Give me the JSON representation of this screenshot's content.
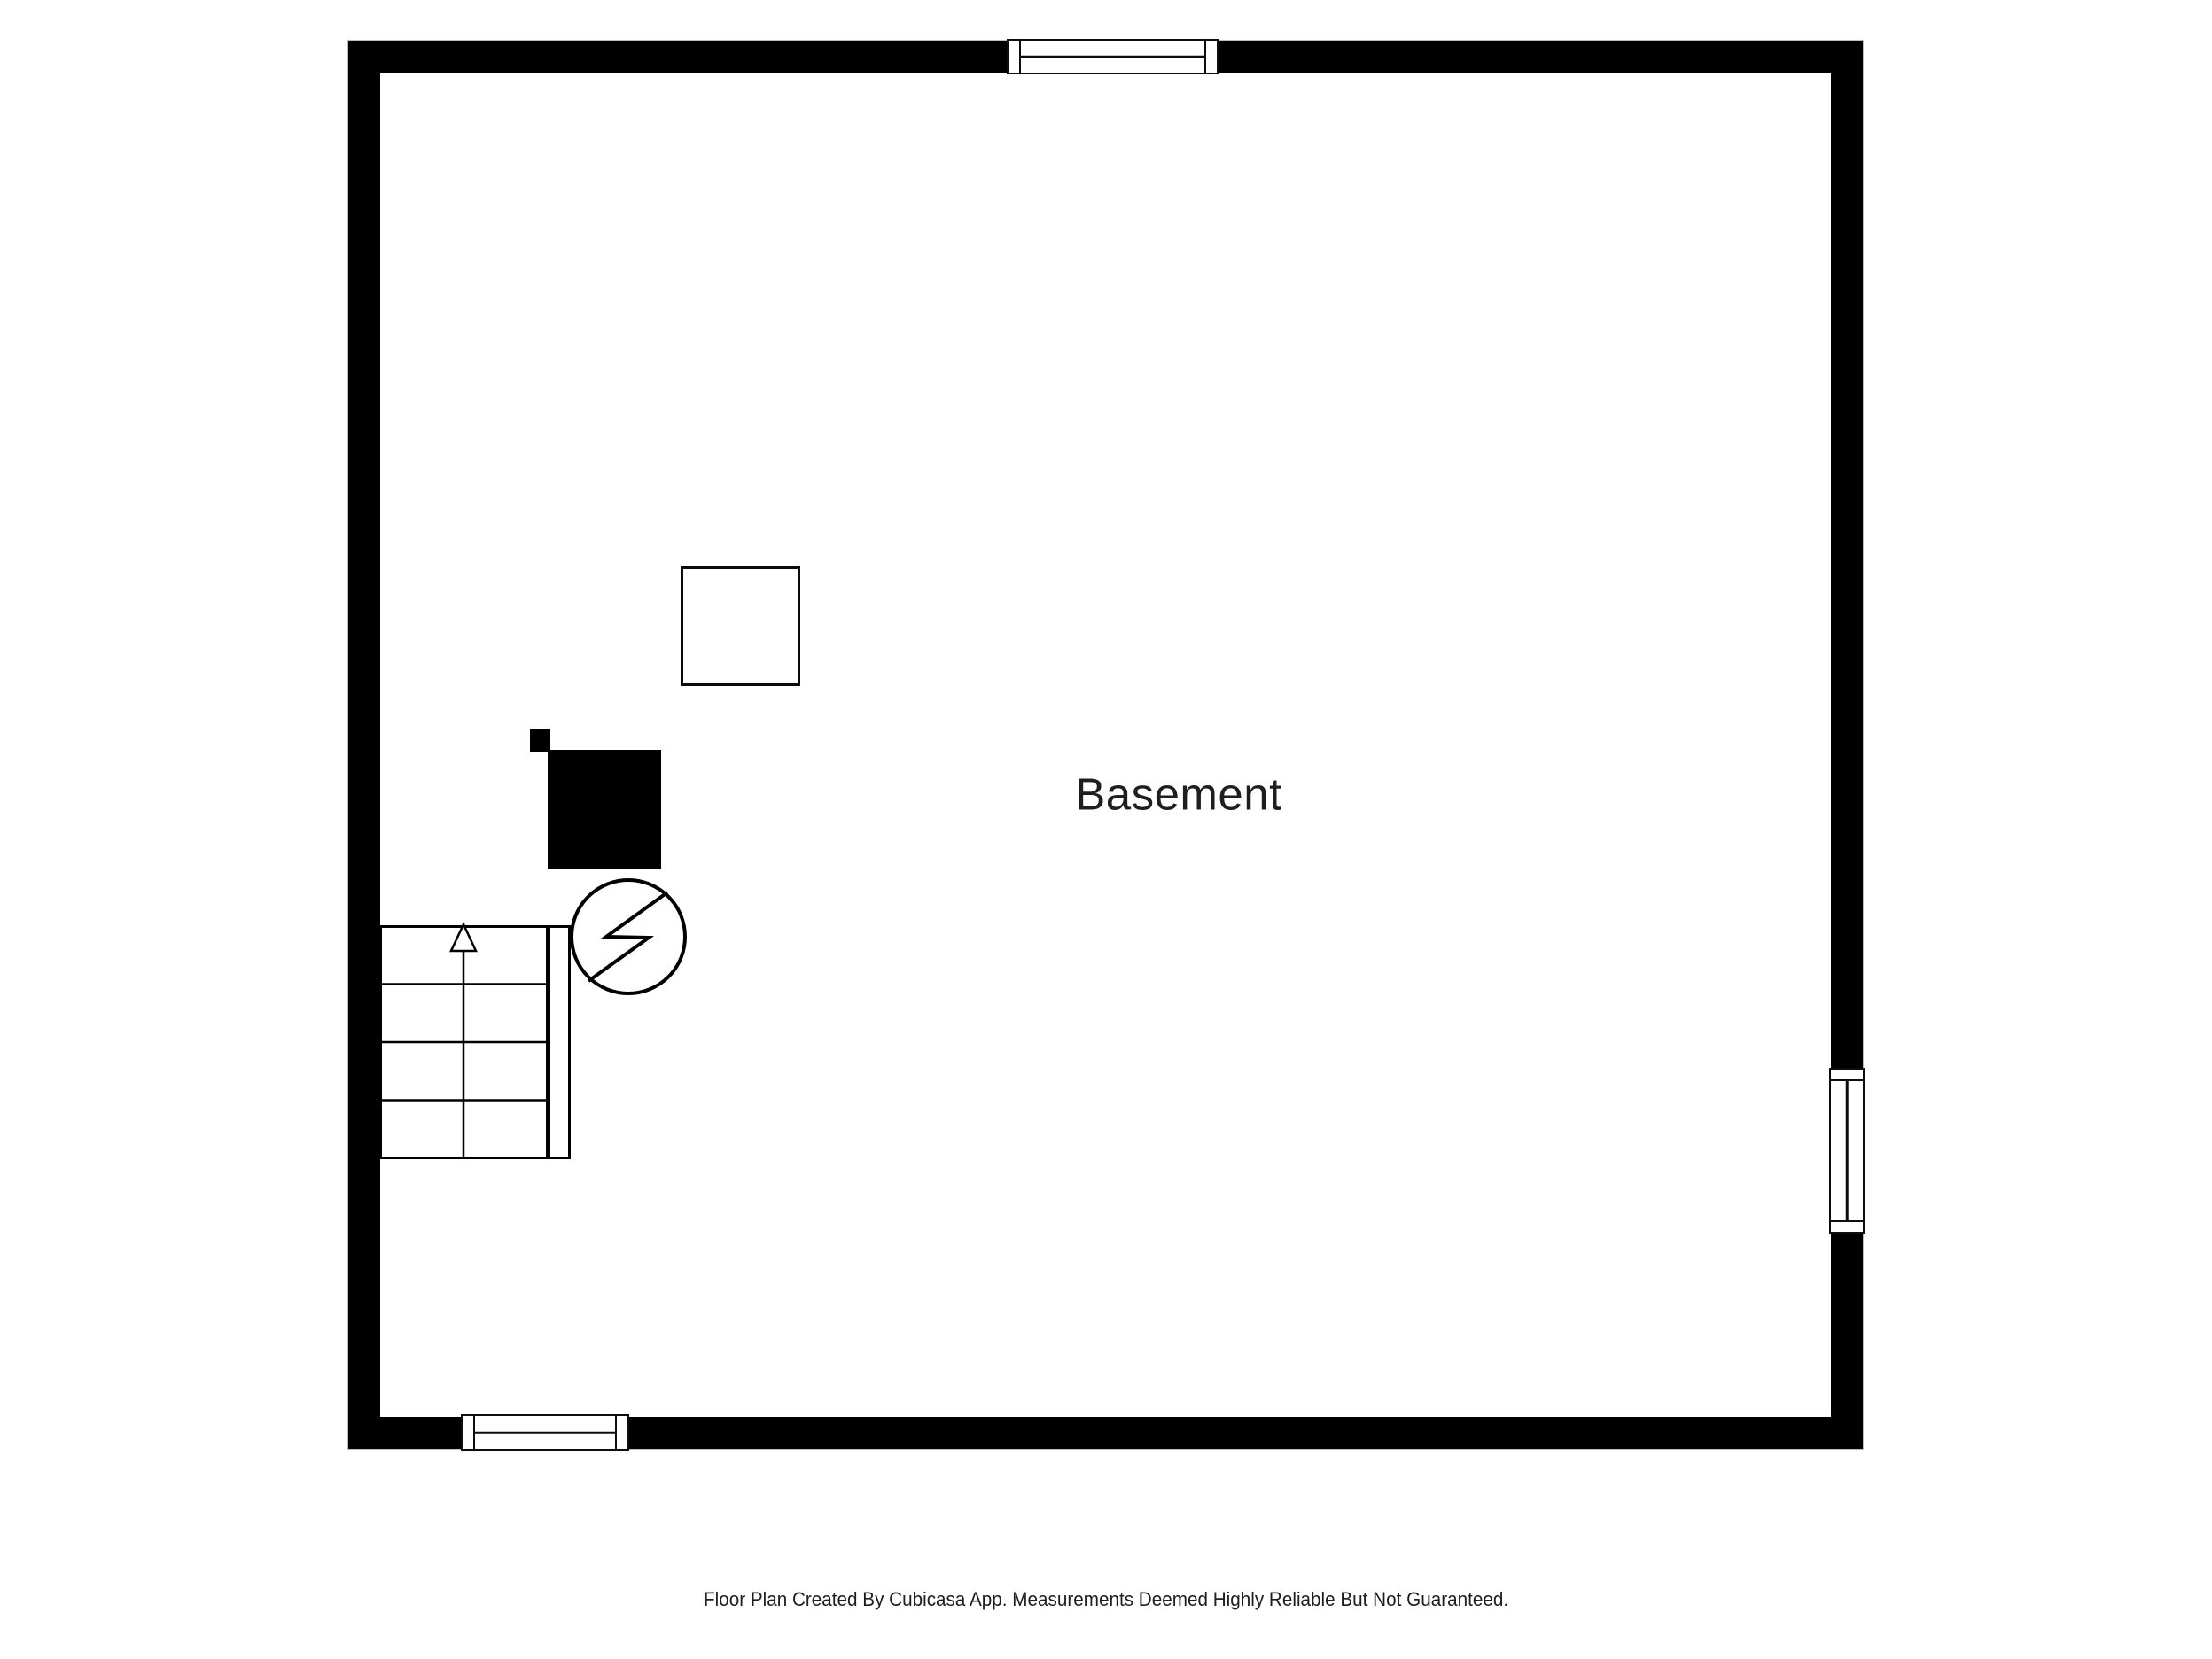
{
  "canvas": {
    "background": "#ffffff",
    "wall_color": "#000000",
    "line_color": "#000000",
    "text_color": "#1e1e1e"
  },
  "room": {
    "label": "Basement"
  },
  "symbols": {
    "windows": [
      "top-wall-window",
      "bottom-wall-window",
      "right-wall-window"
    ],
    "staircase": "staircase-4-treads-up-arrow",
    "stair_railing": "stair-railing-bar",
    "electrical": "circle-lightning-bolt-device",
    "furnace_block": "solid-black-block",
    "flue_block": "small-solid-black-block",
    "utility_box": "open-square-outline"
  },
  "footer": {
    "disclaimer": "Floor Plan Created By Cubicasa App. Measurements Deemed Highly Reliable But Not Guaranteed."
  }
}
